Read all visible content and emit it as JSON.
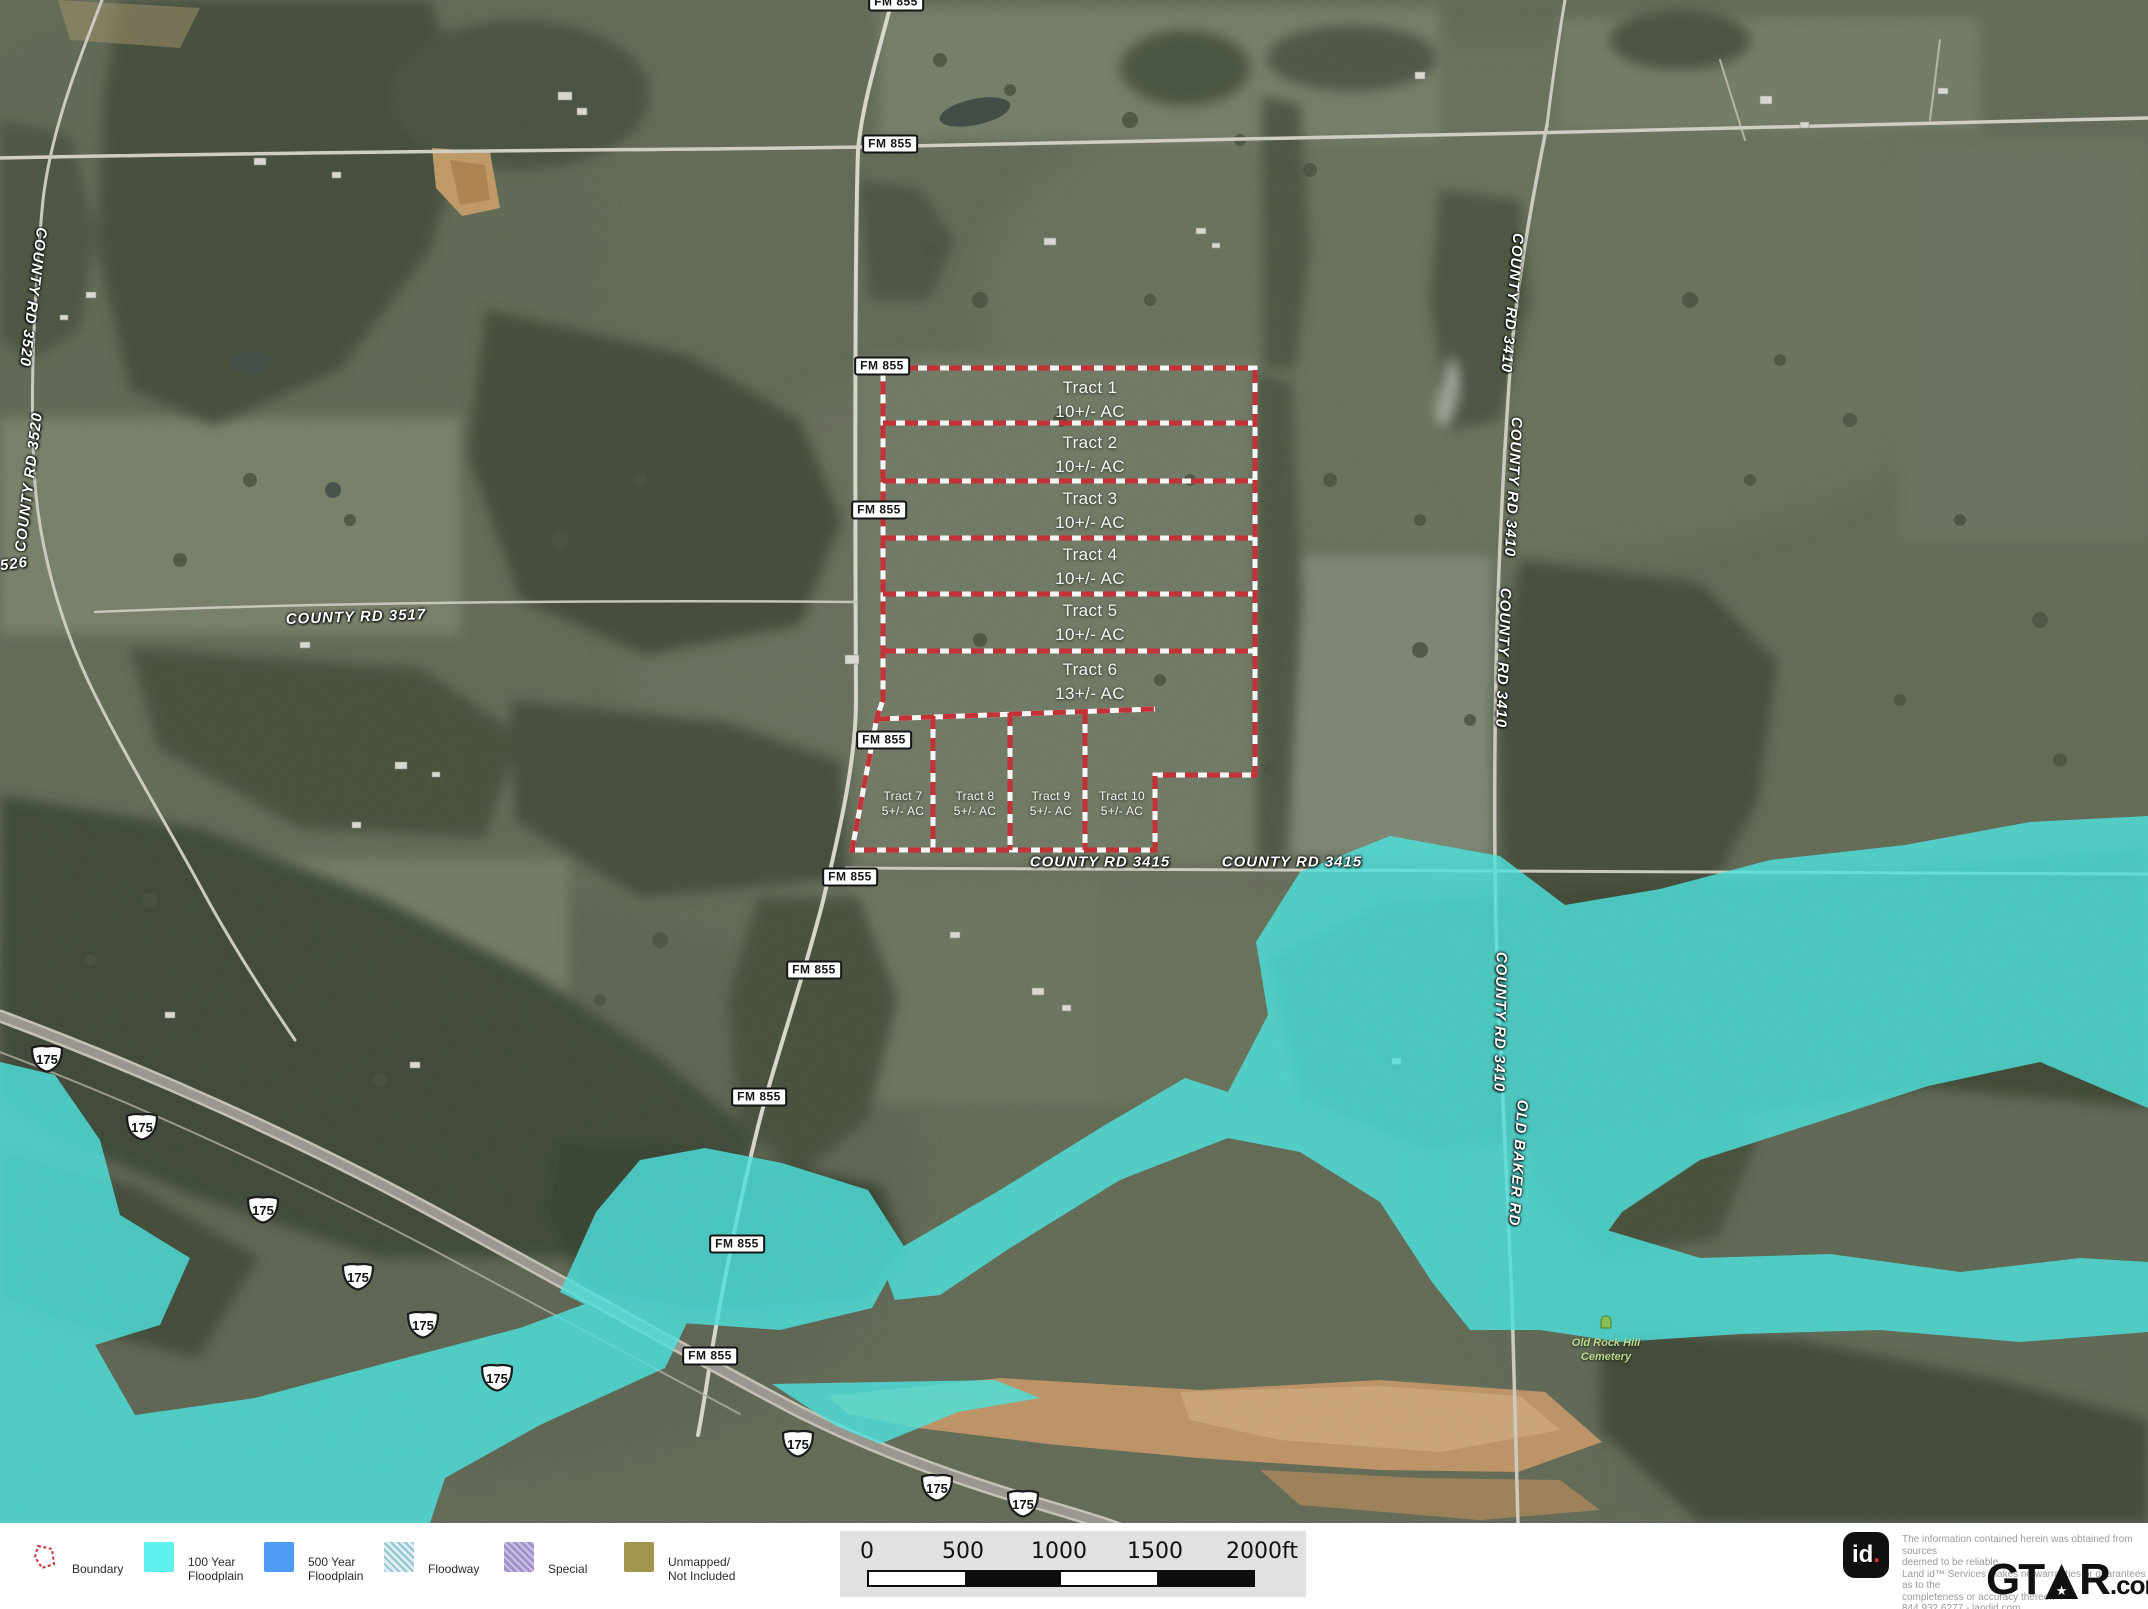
{
  "map": {
    "fm_label": "FM 855",
    "shield_text": "175",
    "road_labels": {
      "county_rd_3520_a": "COUNTY RD 3520",
      "county_rd_3520_b": "COUNTY RD 3520",
      "county_rd_3526_fragment": "526",
      "county_rd_3517": "COUNTY RD 3517",
      "county_rd_3415_a": "COUNTY RD 3415",
      "county_rd_3415_b": "COUNTY RD 3415",
      "county_rd_3410_a": "COUNTY RD 3410",
      "county_rd_3410_b": "COUNTY RD 3410",
      "county_rd_3410_c": "COUNTY RD 3410",
      "county_rd_3410_d": "COUNTY RD 3410",
      "old_baker_rd": "OLD BAKER RD"
    },
    "cemetery": {
      "line1": "Old Rock Hill",
      "line2": "Cemetery"
    },
    "tracts": [
      {
        "name": "Tract 1",
        "acreage": "10+/- AC"
      },
      {
        "name": "Tract 2",
        "acreage": "10+/- AC"
      },
      {
        "name": "Tract 3",
        "acreage": "10+/- AC"
      },
      {
        "name": "Tract 4",
        "acreage": "10+/- AC"
      },
      {
        "name": "Tract 5",
        "acreage": "10+/- AC"
      },
      {
        "name": "Tract 6",
        "acreage": "13+/- AC"
      },
      {
        "name": "Tract 7",
        "acreage": "5+/- AC"
      },
      {
        "name": "Tract 8",
        "acreage": "5+/- AC"
      },
      {
        "name": "Tract 9",
        "acreage": "5+/- AC"
      },
      {
        "name": "Tract 10",
        "acreage": "5+/- AC"
      }
    ]
  },
  "legend": {
    "boundary_label": "Boundary",
    "items": [
      {
        "line1": "100 Year",
        "line2": "Floodplain",
        "color": "#5ef0ec"
      },
      {
        "line1": "500 Year",
        "line2": "Floodplain",
        "color": "#4d9bf3"
      },
      {
        "line1": "Floodway",
        "line2": "",
        "color": "#dceef2"
      },
      {
        "line1": "Special",
        "line2": "",
        "color": "#a391cc"
      },
      {
        "line1": "Unmapped/",
        "line2": "Not Included",
        "color": "#a3954f"
      }
    ]
  },
  "scalebar": {
    "ticks": [
      "0",
      "500",
      "1000",
      "1500",
      "2000ft"
    ]
  },
  "attribution": {
    "id_logo_text": "id",
    "id_logo_dot": ".",
    "disclaimer_lines": [
      "The information contained herein was obtained from sources",
      "deemed to be reliable.",
      "Land id™ Services makes no warranties or guarantees as to the",
      "completeness or accuracy thereof.",
      "844.932.6277 - landid.com"
    ],
    "brand_gt": "GT",
    "brand_star": "★",
    "brand_r": "R",
    "brand_com": ".com"
  },
  "colors": {
    "boundary_red": "#c41f24",
    "floodplain_cyan": "#3fe6e1",
    "road_label_white": "#ffffff",
    "cemetery_green": "#b9da8a"
  }
}
